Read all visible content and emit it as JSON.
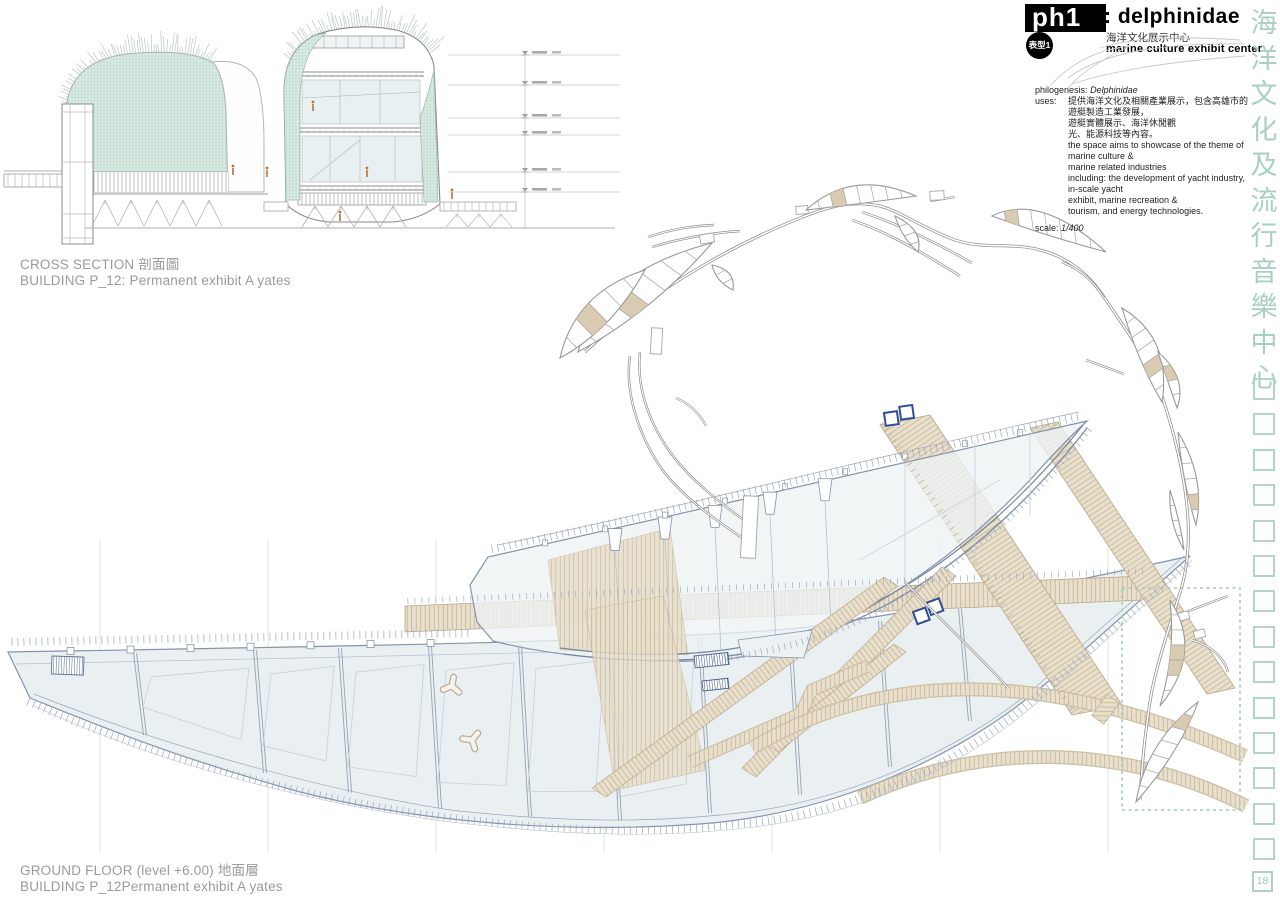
{
  "page": {
    "background": "#ffffff"
  },
  "header": {
    "ph_code": "ph1",
    "title": ": delphinidae",
    "subtitle_zh": "海洋文化展示中心",
    "subtitle_en": "marine culture exhibit center",
    "badge": "表型1"
  },
  "info": {
    "philogenesis_label": "philogenesis:",
    "philogenesis_value": "Delphinidae",
    "uses_label": "uses:",
    "uses_zh_lines": [
      "提供海洋文化及相關產業展示，包含高雄市的遊艇製造工業發展，",
      "遊艇實體展示、海洋休閒觀",
      "光、能源科技等內容。"
    ],
    "uses_en_lines": [
      "the space aims to showcase of the theme of marine culture &",
      "marine related industries",
      "including: the development of yacht industry, in-scale yacht",
      "exhibit, marine recreation &",
      "tourism, and energy technologies."
    ],
    "scale_label": "scale:",
    "scale_value": "1/400"
  },
  "drawings": {
    "cross_section": {
      "title": "CROSS SECTION",
      "title_zh": "剖面圖",
      "subtitle": "BUILDING P_12: Permanent exhibit A yates"
    },
    "ground_floor": {
      "title": "GROUND FLOOR",
      "level_note": "(level +6.00)",
      "title_zh": "地面層",
      "subtitle": "BUILDING P_12Permanent exhibit A yates"
    }
  },
  "side_column": {
    "vertical_title": "海洋文化及流行音樂中心",
    "placeholder_count": 14,
    "page_number": "18"
  },
  "colors": {
    "teal_text": "#a8d0c1",
    "mesh_green": "#b4d6c6",
    "wood_fill": "#e8dfcc",
    "wood_line": "#c3b290",
    "tan_room": "#d9cbb2",
    "plan_line": "#8494ad",
    "pale_fill": "#eaf0f1",
    "accent_blue": "#2e4f96",
    "label_gray": "#9a9a9a",
    "figure_orange": "#b5742f"
  }
}
